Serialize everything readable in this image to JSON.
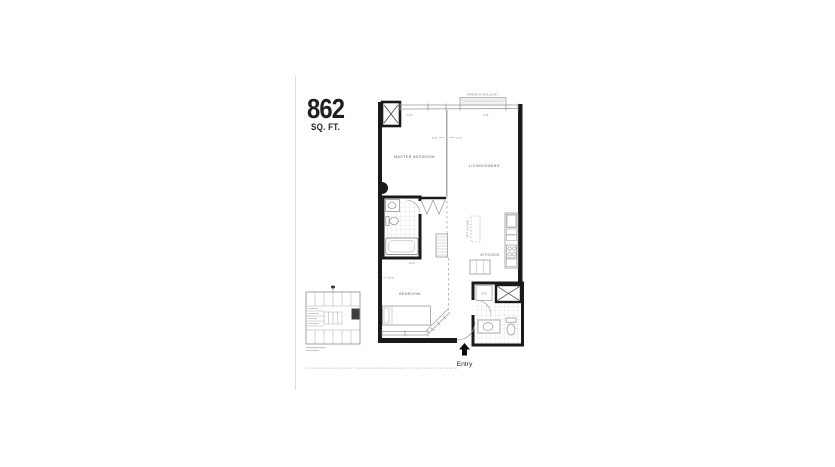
{
  "document": {
    "title_number": "862",
    "title_unit": "SQ. FT.",
    "fine_print": "All dimensions are approximate. Sizes and specifications are subject to change without notice. E.&O.E."
  },
  "plan": {
    "rooms": {
      "master_bedroom": "MASTER BEDROOM",
      "living_dining": "LIVING/DINING",
      "kitchen": "KITCHEN",
      "bedroom": "BEDROOM"
    },
    "features": {
      "french_balcony": "FRENCH BALCONY",
      "washer_dryer": "W/D",
      "island": "OPT. ISLAND",
      "entry": "Entry"
    },
    "dimensions": {
      "master_width": "17'0\"",
      "living_width": "17'0\"",
      "top_left": "14'2\"",
      "balcony": "17'8\"",
      "bedroom": "10'0\"",
      "hall": "12'2\""
    }
  },
  "colors": {
    "wall": "#1a1a1a",
    "thin_line": "#8f8f8f",
    "tile_line": "#cccccc",
    "accent": "#0a0a0a"
  }
}
